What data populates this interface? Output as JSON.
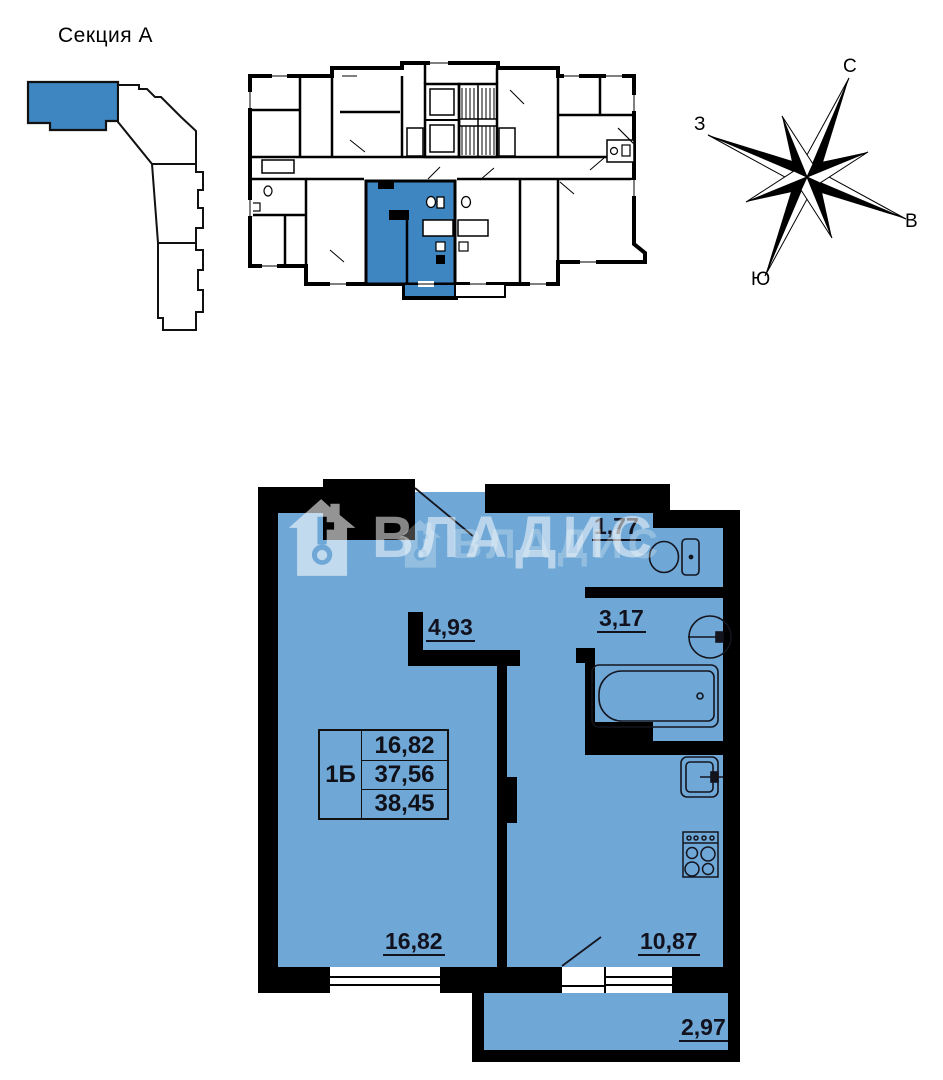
{
  "site_plan": {
    "title": "Секция А"
  },
  "compass": {
    "north": "С",
    "east": "В",
    "south": "Ю",
    "west": "З"
  },
  "apartment": {
    "rooms": {
      "entry_hall": "4,93",
      "wc": "1,77",
      "bathroom": "3,17",
      "living_room": "16,82",
      "kitchen": "10,87",
      "balcony": "2,97"
    },
    "info_table": {
      "unit_type": "1Б",
      "living_area": "16,82",
      "area": "37,56",
      "total_area": "38,45"
    }
  },
  "watermark": {
    "brand": "ВЛАДИС"
  },
  "colors": {
    "plan_fill": "#6FA8D6",
    "unit_highlight": "#3E86C2",
    "wall": "#000000",
    "label": "#12121E"
  }
}
